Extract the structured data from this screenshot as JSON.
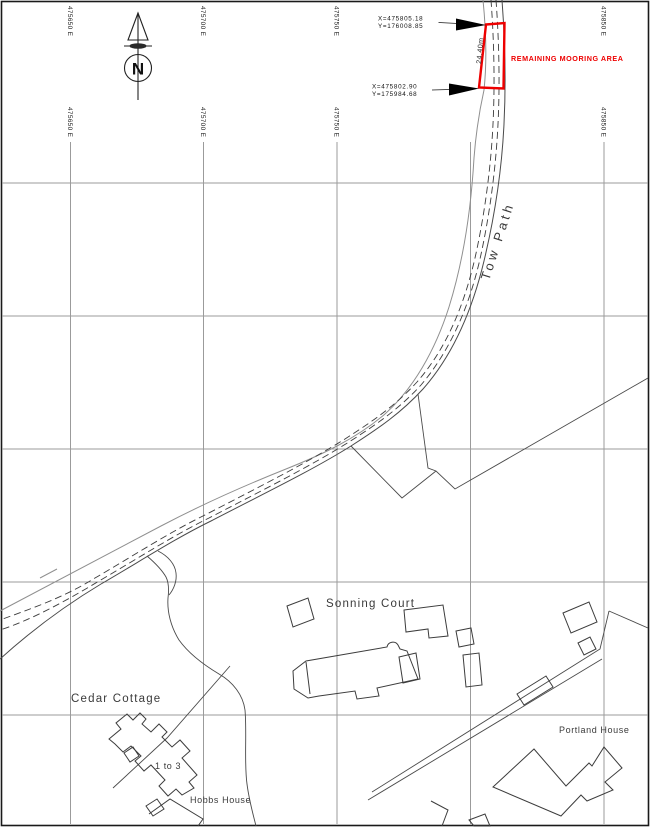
{
  "grid": {
    "easting_labels": [
      {
        "label": "475650 E"
      },
      {
        "label": "475700 E"
      },
      {
        "label": "475750 E"
      },
      {
        "label": "475850 E"
      }
    ]
  },
  "north_arrow": {
    "letter": "N"
  },
  "annotations": {
    "mooring_area_label": "REMAINING MOORING AREA",
    "mooring_length": "24.40m",
    "coord_top": {
      "x": "X=475805.18",
      "y": "Y=176008.85"
    },
    "coord_bottom": {
      "x": "X=475802.90",
      "y": "Y=175984.68"
    }
  },
  "labels": {
    "tow_path": "Tow Path",
    "sonning_court": "Sonning Court",
    "cedar_cottage": "Cedar Cottage",
    "one_to_three": "1 to 3",
    "hobbs_house": "Hobbs House",
    "portland_house": "Portland House"
  },
  "colors": {
    "mooring_red": "#ee0000",
    "grid_gray": "#9b9b9b",
    "bank_light": "#8f8f8f",
    "line_dark": "#3c3c3c",
    "paper": "#ffffff"
  }
}
